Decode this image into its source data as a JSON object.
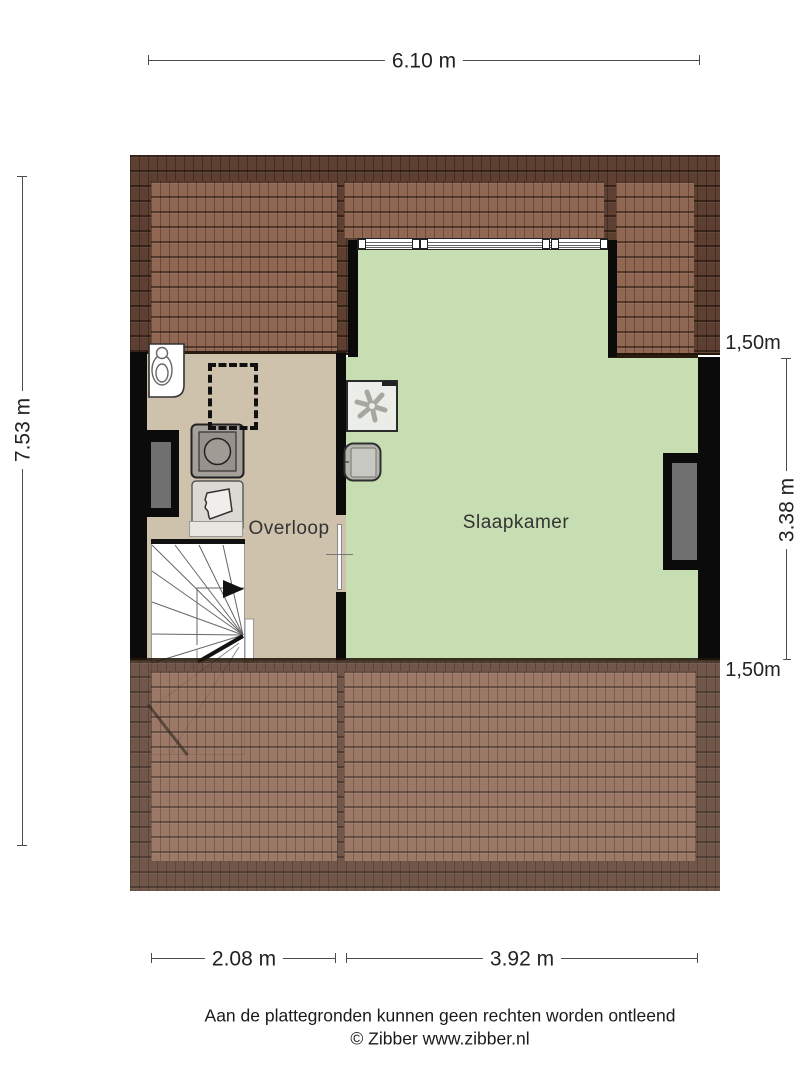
{
  "colors": {
    "roof-dark": "#5d4031",
    "roof-light": "#8f6753",
    "floor-overloop": "#cec2ad",
    "floor-slaapkamer": "#c6deb2",
    "wall": "#0b0b0b",
    "window-pane": "#707070",
    "dim-line": "#4c4c4c",
    "text": "#222222"
  },
  "dimensions": {
    "top": "6.10 m",
    "left": "7.53 m",
    "right_top": "1,50m",
    "right_middle": "3.38 m",
    "right_bottom": "1,50m",
    "bottom_left": "2.08 m",
    "bottom_right": "3.92 m"
  },
  "rooms": {
    "overloop": "Overloop",
    "slaapkamer": "Slaapkamer"
  },
  "fixtures": {
    "boiler": "boiler-unit",
    "skylight": "skylight-dashed-outline",
    "washing_machine": "washing-machine",
    "laundry_basket": "laundry-basket",
    "ventilation": "mechanical-ventilation-unit",
    "wall_unit": "wall-mounted-unit",
    "stairs": "winder-staircase",
    "dormer_window": "dormer-window",
    "window_left": "side-window-left",
    "window_right": "side-window-right",
    "door": "door-opening"
  },
  "footer": {
    "disclaimer": "Aan de plattegronden kunnen geen rechten worden ontleend",
    "copyright": "© Zibber www.zibber.nl"
  }
}
